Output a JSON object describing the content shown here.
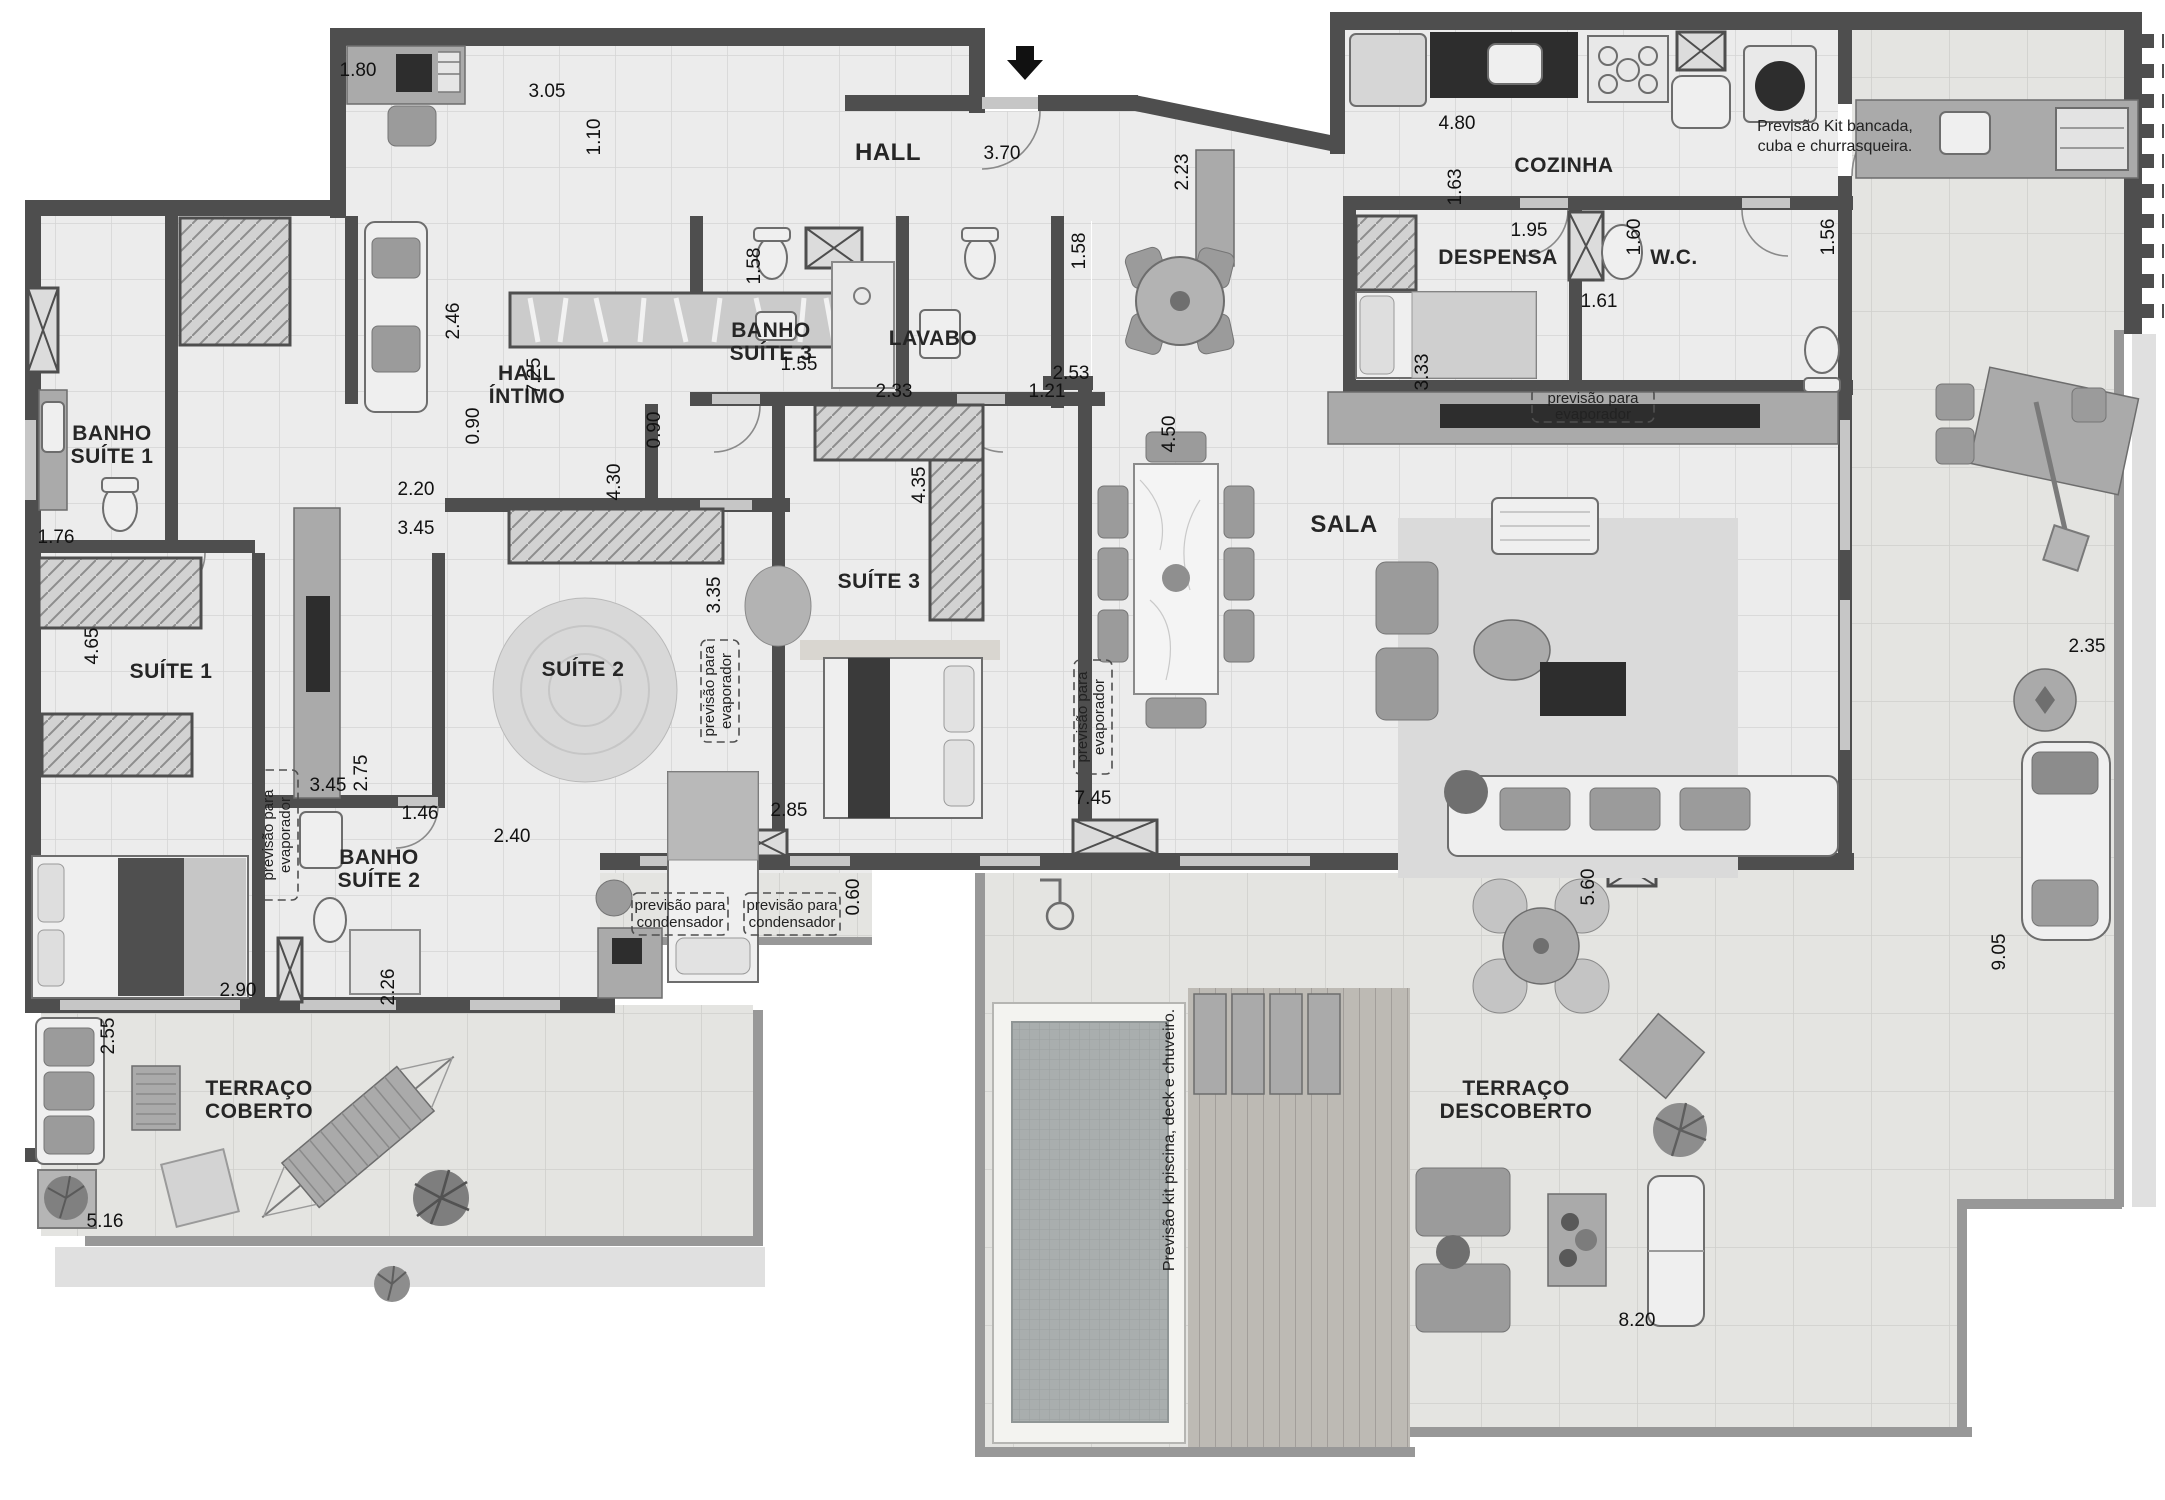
{
  "meta": {
    "type": "architectural-floor-plan",
    "description": "Grayscale penthouse apartment floor plan with three suites, social area, kitchen and terraces with pool",
    "colors": {
      "wall": "#4e4e4e",
      "floor": "#ececec",
      "terrace": "#e3e3e0",
      "water": "#a9aeae",
      "dark_furniture": "#2d2d2d"
    }
  },
  "labels": {
    "hall": "HALL",
    "hall_intimo_1": "HALL",
    "hall_intimo_2": "ÍNTIMO",
    "banho_suite1_1": "BANHO",
    "banho_suite1_2": "SUÍTE 1",
    "suite1": "SUÍTE 1",
    "suite2": "SUÍTE 2",
    "suite3": "SUÍTE 3",
    "banho_suite2_1": "BANHO",
    "banho_suite2_2": "SUÍTE 2",
    "banho_suite3_1": "BANHO",
    "banho_suite3_2": "SUÍTE 3",
    "lavabo": "LAVABO",
    "cozinha": "COZINHA",
    "despensa": "DESPENSA",
    "wc": "W.C.",
    "sala": "SALA",
    "terraco_coberto_1": "TERRAÇO",
    "terraco_coberto_2": "COBERTO",
    "terraco_descoberto_1": "TERRAÇO",
    "terraco_descoberto_2": "DESCOBERTO"
  },
  "annotations": {
    "kit_bancada_1": "Previsão Kit bancada,",
    "kit_bancada_2": "cuba e churrasqueira.",
    "kit_piscina": "Previsão kit piscina, deck e chuveiro.",
    "evaporador_1": "previsão para",
    "evaporador_2": "evaporador",
    "condensador_1": "previsão para",
    "condensador_2": "condensador"
  },
  "dimensions": [
    "1.80",
    "3.05",
    "1.10",
    "3.70",
    "4.80",
    "2.23",
    "1.63",
    "1.95",
    "1.60",
    "1.56",
    "1.61",
    "2.53",
    "3.33",
    "4.50",
    "2.46",
    "7.25",
    "1.55",
    "1.58",
    "1.58",
    "2.33",
    "1.21",
    "1.76",
    "4.65",
    "2.20",
    "3.45",
    "0.90",
    "0.90",
    "4.30",
    "3.35",
    "4.35",
    "2.75",
    "3.45",
    "1.46",
    "2.40",
    "2.26",
    "2.90",
    "2.55",
    "5.16",
    "0.60",
    "2.85",
    "7.45",
    "5.60",
    "8.20",
    "9.05",
    "2.35"
  ]
}
